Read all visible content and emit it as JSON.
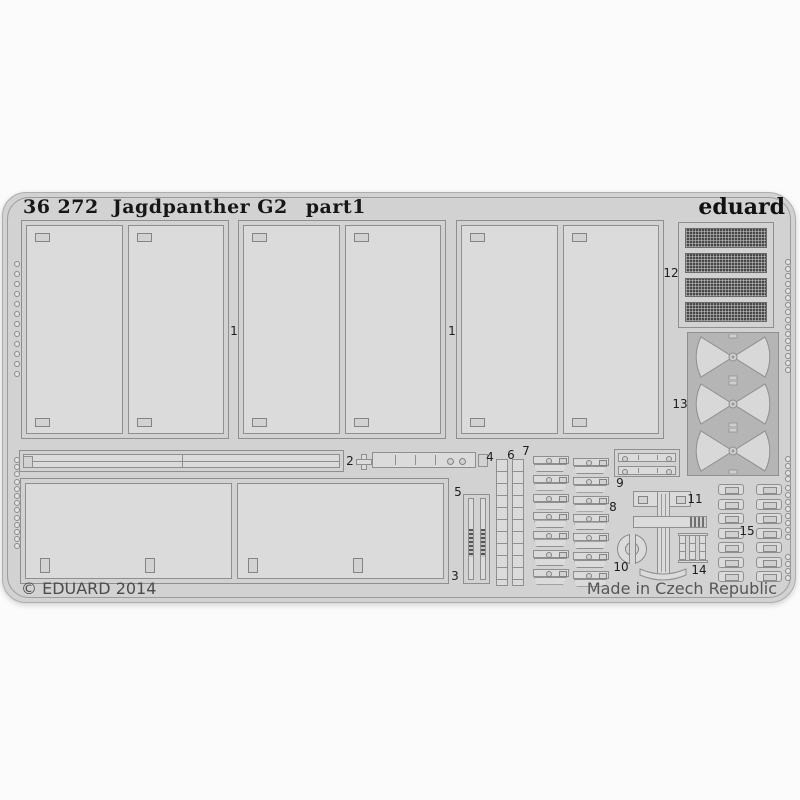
{
  "colors": {
    "page-bg": "#fbfbfb",
    "sheet": "#d2d2d2",
    "panel": "#dbdbdb",
    "line": "#8f8f8f",
    "mesh": "#484848",
    "bowtie-bg": "#b5b5b5",
    "title-text": "#161616",
    "footer-text": "#4c4c4c",
    "label-text": "#1d1d1d"
  },
  "header": {
    "catalog_number": "36 272",
    "product_name": "Jagdpanther G2",
    "part": "part1",
    "brand": "eduard"
  },
  "footer": {
    "copyright": "© EDUARD 2014",
    "origin": "Made in Czech Republic"
  },
  "part_labels": [
    "1",
    "1",
    "2",
    "3",
    "4",
    "5",
    "6",
    "7",
    "8",
    "9",
    "10",
    "11",
    "12",
    "13",
    "14",
    "15"
  ],
  "fret_features": {
    "door_panel_groups": 3,
    "panels_per_group": 2,
    "bottom_panels": 2,
    "grille_mesh_rows": 4,
    "bowtie_shapes": 3,
    "clamp_column_left_count": 7,
    "clamp_column_right_count": 7,
    "bracket_columns": 2,
    "brackets_per_column": 7
  },
  "sprocket_holes": {
    "hole_groups": [
      {
        "edge": "left",
        "x": 11,
        "y": 68,
        "count": 12,
        "gap": 10
      },
      {
        "edge": "left",
        "x": 11,
        "y": 264,
        "count": 13,
        "gap": 7.2
      },
      {
        "edge": "right",
        "x": 782,
        "y": 66,
        "count": 16,
        "gap": 7.2
      },
      {
        "edge": "right",
        "x": 782,
        "y": 263,
        "count": 4,
        "gap": 6.8
      },
      {
        "edge": "right",
        "x": 782,
        "y": 292,
        "count": 8,
        "gap": 7
      },
      {
        "edge": "right",
        "x": 782,
        "y": 361,
        "count": 4,
        "gap": 7
      }
    ]
  }
}
